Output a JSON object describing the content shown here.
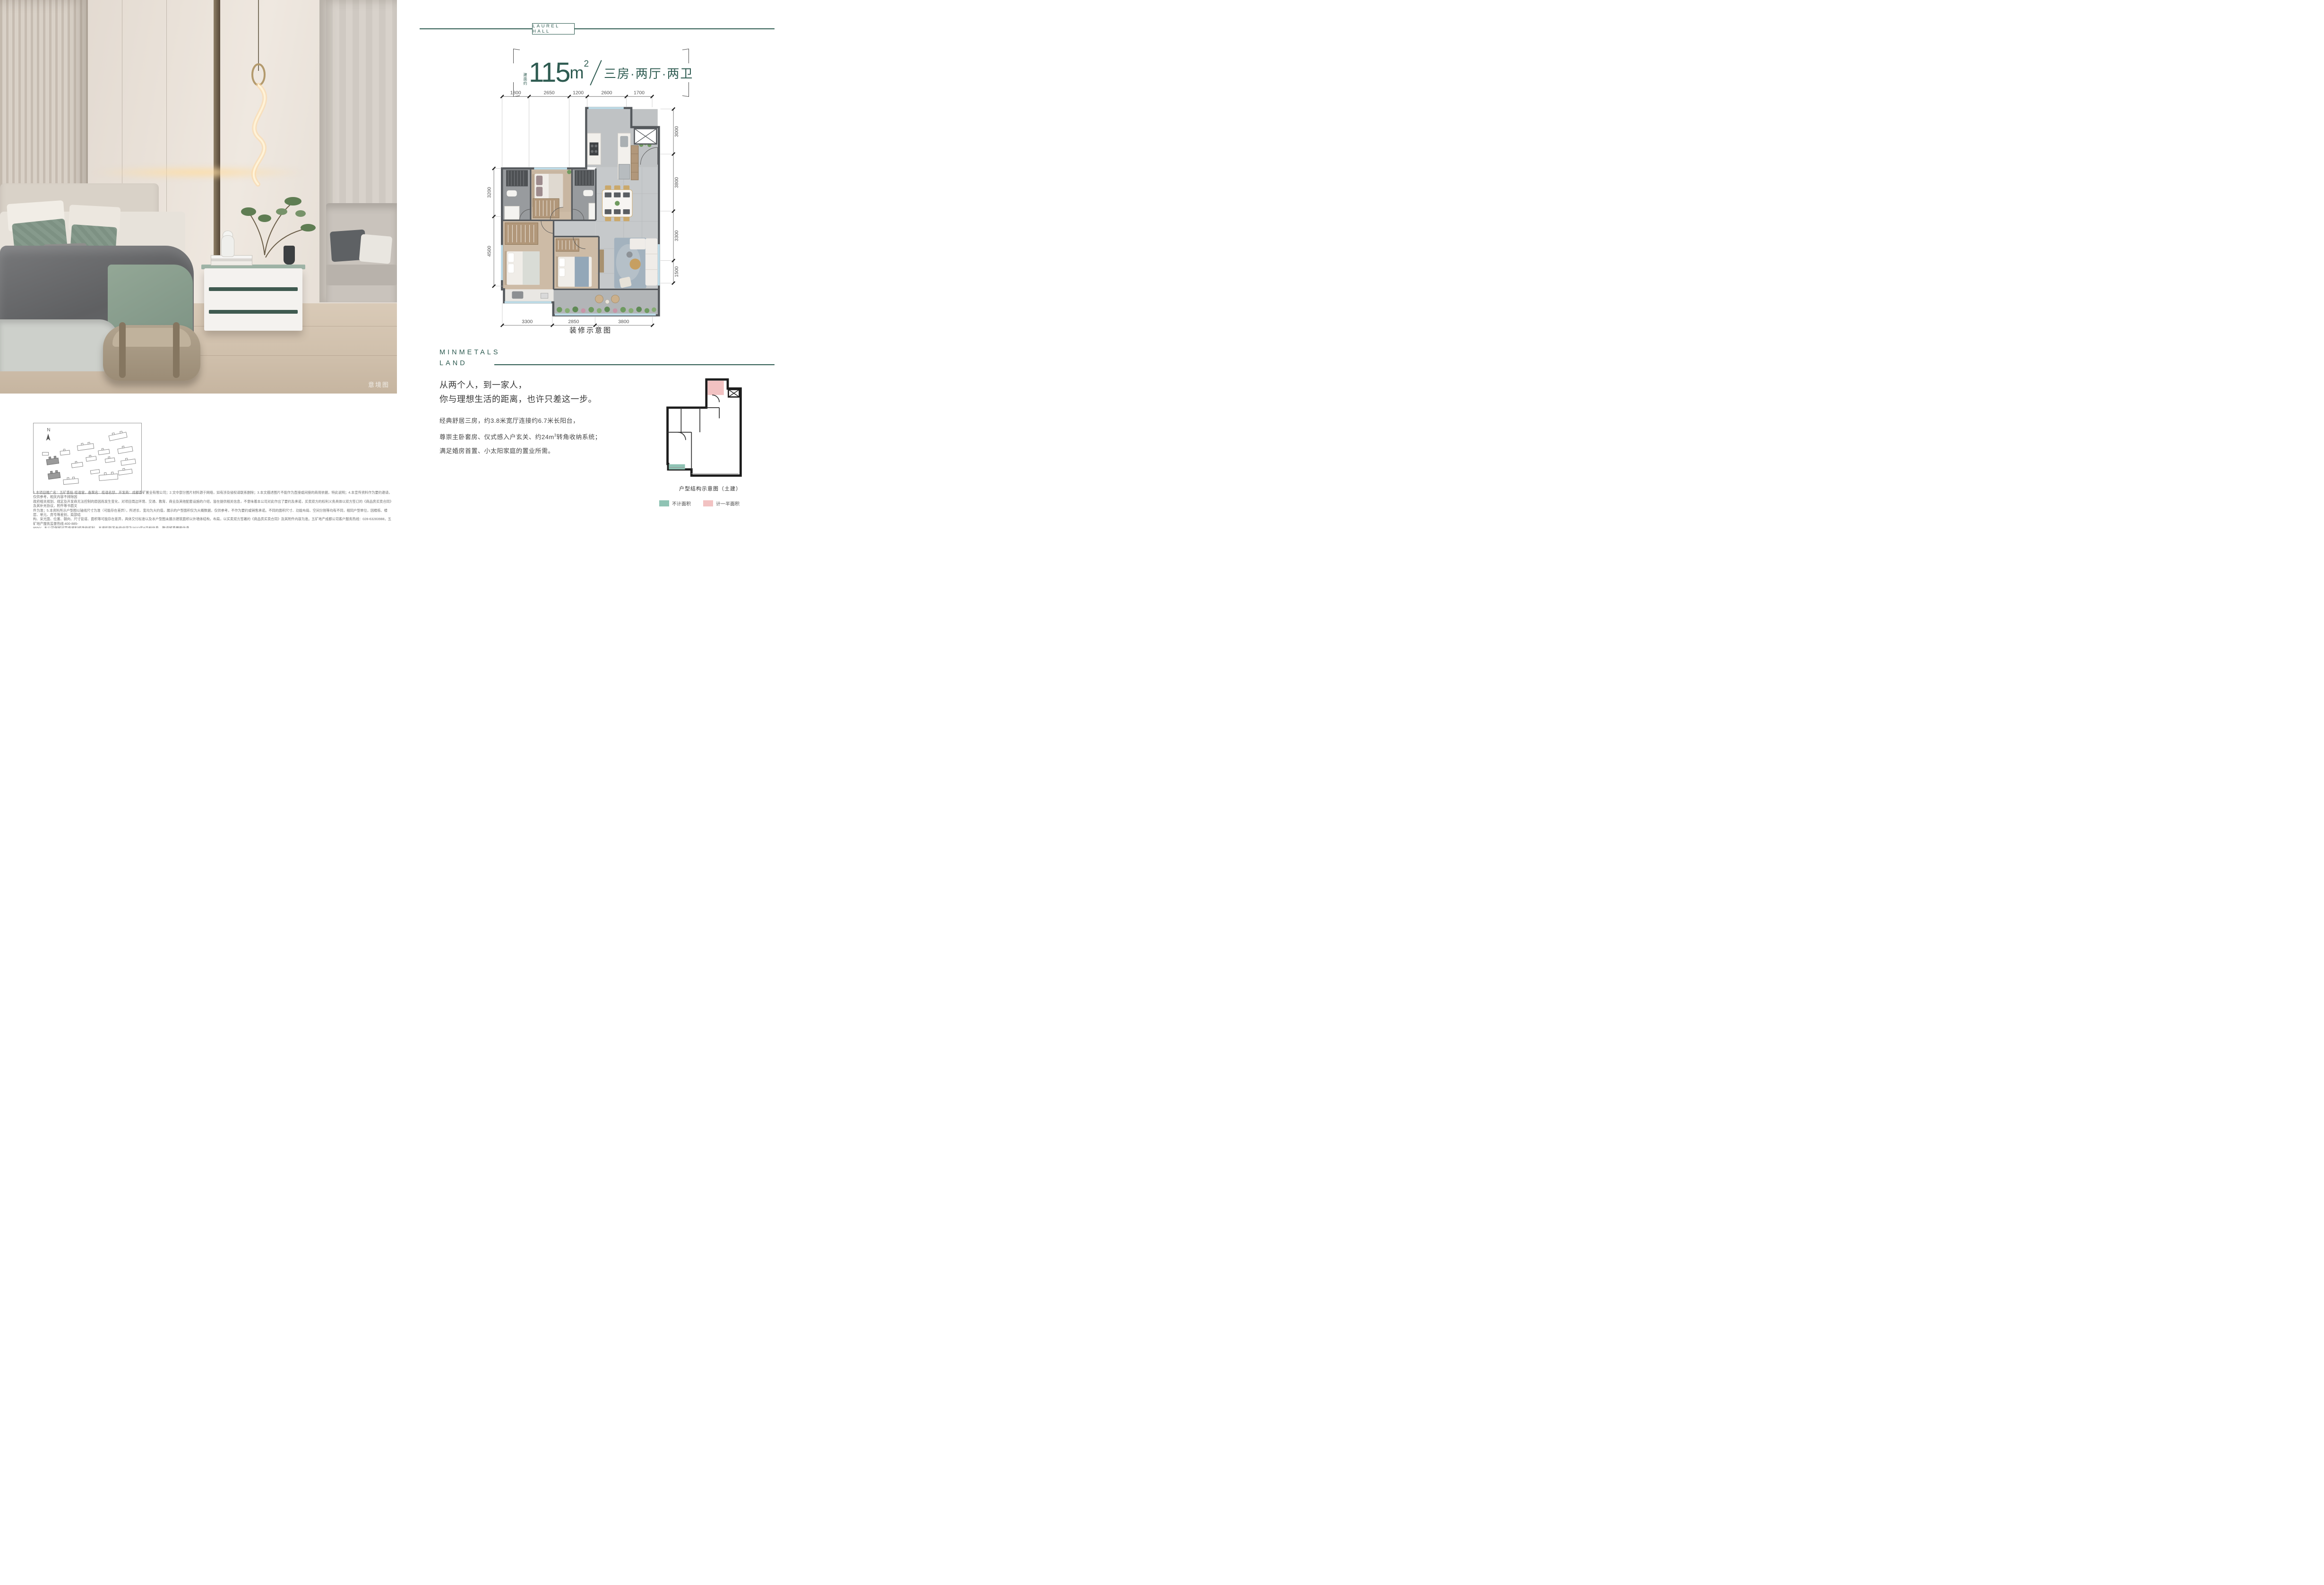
{
  "colors": {
    "brand_teal": "#2e5b51",
    "legend_teal": "#8fc3b4",
    "legend_pink": "#f2c2c2",
    "plan_wall": "#55595d",
    "plan_wood": "#cdbba6",
    "plan_tile": "#c6c9cb"
  },
  "header": {
    "badge": "LAUREL HALL"
  },
  "title": {
    "area_prefix": "建面约",
    "area_value": "115",
    "area_unit": "m",
    "area_sup": "2",
    "layout": "三房·两厅·两卫"
  },
  "photo": {
    "tag": "意境图"
  },
  "sitemap": {
    "north_label": "N"
  },
  "plan": {
    "caption": "装修示意图",
    "dims": {
      "top": [
        "1800",
        "2650",
        "1200",
        "2600",
        "1700"
      ],
      "bottom": [
        "3300",
        "2850",
        "3800"
      ],
      "left": [
        "3200",
        "4500"
      ],
      "right": [
        "3000",
        "3800",
        "3300",
        "1500"
      ]
    }
  },
  "brand": {
    "line1": "MINMETALS",
    "line2": "LAND"
  },
  "headline": {
    "line1": "从两个人，到一家人，",
    "line2": "你与理想生活的距离，也许只差这一步。"
  },
  "body": {
    "line1": "经典舒居三房，约3.8米宽厅连接约6.7米长阳台，",
    "line2_pre": "尊崇主卧套房、仪式感入户玄关、约24m",
    "line2_sup": "3",
    "line2_post": "转角收纳系统；",
    "line3": "满足婚房首置、小太阳家庭的置业所需。"
  },
  "mini_plan": {
    "caption": "户型结构示意图（土建）",
    "legend_1": "不计面积",
    "legend_2": "计一半面积"
  },
  "disclaimer": {
    "line1": "1.本项目推广名：五矿香投·桂语堂，备案名：桂语名邸，开发商：成都香矿置业有限公司；2.文中部分图片材料源于网络，如有涉及侵权请联系删除；3.本文描述图片不能作为直接或间接的商用依据，特此说明；4.本宣传资料作为要约邀请，仅供参考，相关内容不排除因",
    "line2": "政府相关规划、规定及开发商无法控制的原因而发生变化，对项目周边环境、交通、教育、商业及其他配套设施的介绍，皆在提供相关信息，不意味着本公司对此作出了要约及承诺，买卖双方的权利义务具体以双方签订的《商品房买卖合同》及其补充协议，附件等书面文",
    "line3": "件为准；5.本资料所示户型图以轴线尺寸为准（可能存在差异），所述长、宽均为大约值，展示的户型面积仅为大概数据，仅供参考，不作为要约或销售承诺。不同的面积尺寸、功能布局、空间分割等均有不同，相同户型单位，因楼栋、楼层、单元、房号等差别，局部结",
    "line4": "构、采光面、位置、朝向、尺寸管道、面积等可能存在差异，具体交付标准以及本户型图未展示建筑面积以外墙体结构，布局，以买卖双方签署的《商品房买卖合同》及其附件内容为准。五矿地产成都公司客户服务热线：028-63283988，五矿地产服务监督热线:400-885-",
    "line5": "9550；本公司保留对宣传资料修改的权利，本资料所发布的内容为2022年6月前信息，敬请留意最新信息。"
  }
}
